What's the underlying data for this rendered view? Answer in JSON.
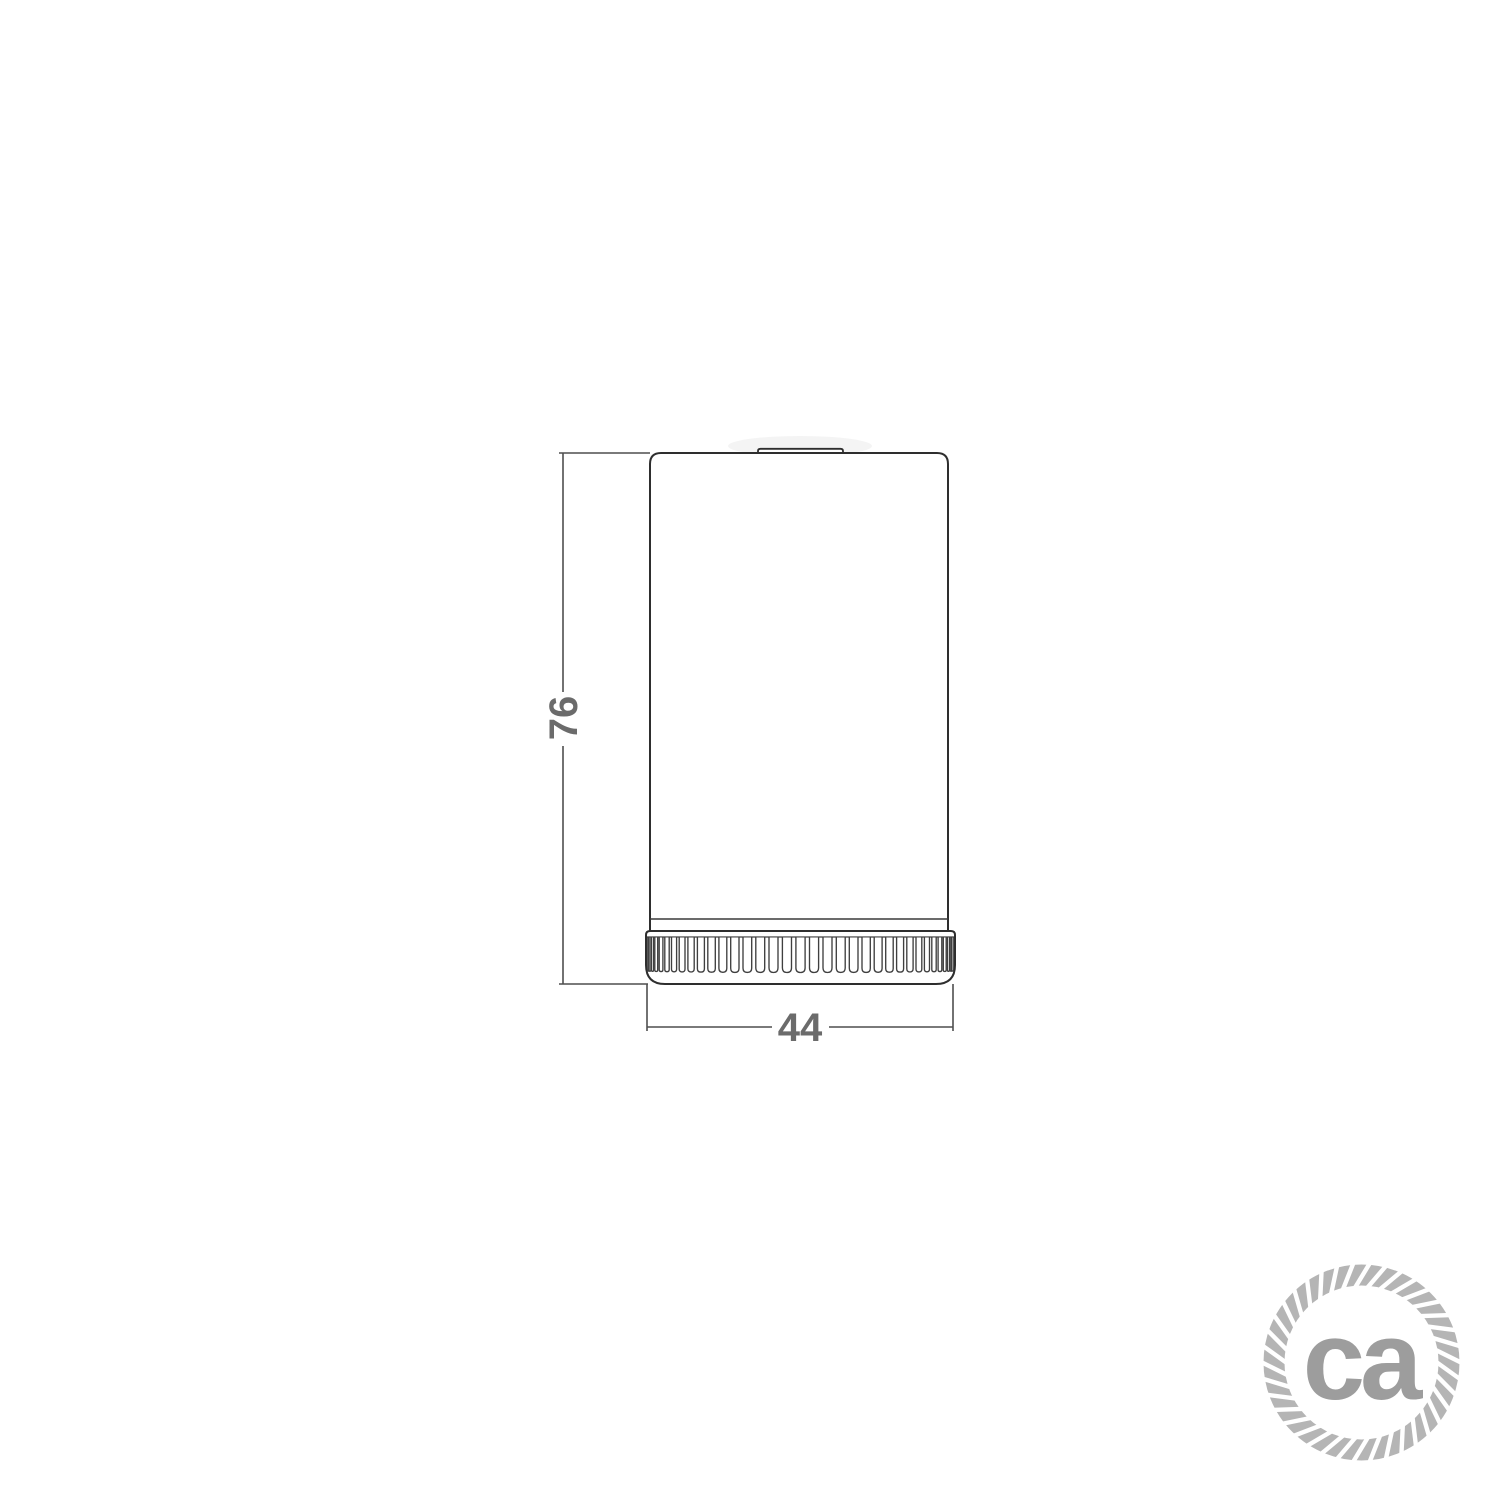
{
  "page": {
    "background_color": "#ffffff"
  },
  "drawing": {
    "type": "technical-dimension-drawing",
    "subject": "cylindrical-lamp-holder-side-view",
    "outline_color": "#2e2e2e",
    "dimension_line_color": "#4f4f4f",
    "dimension_text_color": "#6b6b6b",
    "dimensions": {
      "height_label": "76",
      "width_label": "44"
    }
  },
  "logo": {
    "text": "ca",
    "text_color": "#9d9d9d",
    "rope_color": "#b5b5b5",
    "icon": "rope-circle-logo"
  }
}
